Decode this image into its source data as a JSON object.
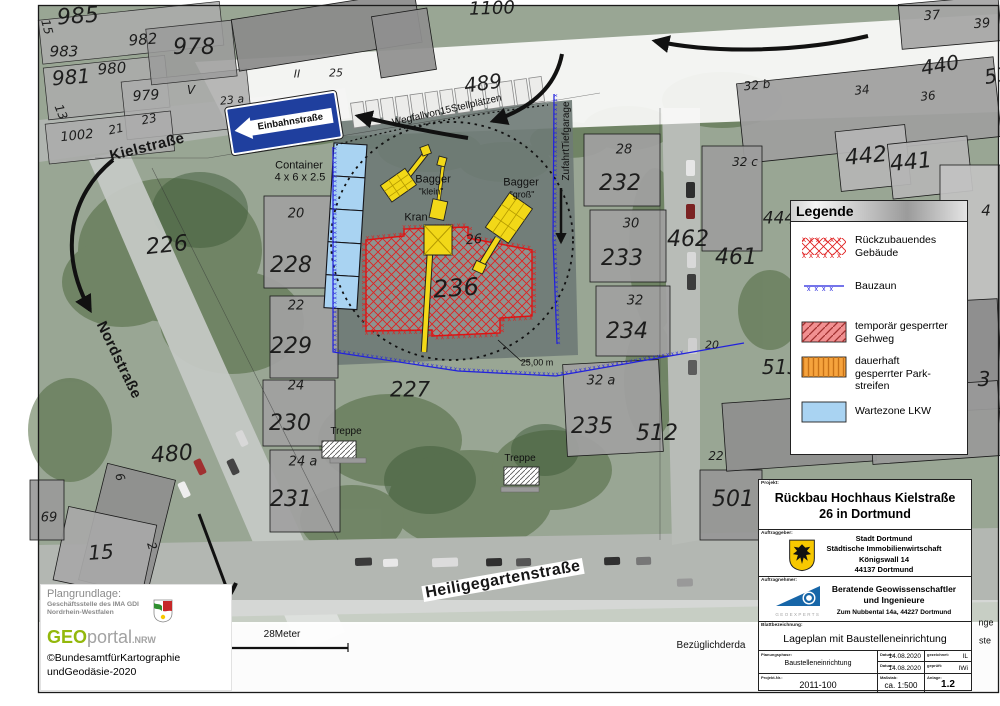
{
  "map": {
    "sign_label": "Einbahnstraße",
    "streets": [
      {
        "t": "Kielstraße",
        "x": 147,
        "y": 147,
        "fs": 15,
        "rot": -14
      },
      {
        "t": "Nordstraße",
        "x": 119,
        "y": 360,
        "fs": 15,
        "rot": 64
      },
      {
        "t": "Heiligegartenstraße",
        "x": 503,
        "y": 580,
        "fs": 16,
        "rot": -10,
        "bg": 1
      }
    ],
    "parcels": [
      {
        "t": "985",
        "x": 78,
        "y": 17,
        "fs": 22,
        "rot": -4
      },
      {
        "t": "15",
        "x": 47,
        "y": 27,
        "fs": 12,
        "rot": 75
      },
      {
        "t": "983",
        "x": 64,
        "y": 52,
        "fs": 15,
        "rot": 0
      },
      {
        "t": "982",
        "x": 143,
        "y": 40,
        "fs": 15,
        "rot": -4
      },
      {
        "t": "978",
        "x": 194,
        "y": 48,
        "fs": 22,
        "rot": 0
      },
      {
        "t": "981",
        "x": 71,
        "y": 77,
        "fs": 20,
        "rot": -4
      },
      {
        "t": "980",
        "x": 112,
        "y": 69,
        "fs": 15,
        "rot": -4
      },
      {
        "t": "979",
        "x": 146,
        "y": 96,
        "fs": 14,
        "rot": -4
      },
      {
        "t": "V",
        "x": 191,
        "y": 90,
        "fs": 12,
        "rot": 0
      },
      {
        "t": "23 a",
        "x": 232,
        "y": 100,
        "fs": 11,
        "rot": -6
      },
      {
        "t": "13",
        "x": 61,
        "y": 112,
        "fs": 12,
        "rot": 68
      },
      {
        "t": "21",
        "x": 116,
        "y": 129,
        "fs": 12,
        "rot": -12
      },
      {
        "t": "23",
        "x": 149,
        "y": 119,
        "fs": 12,
        "rot": -12
      },
      {
        "t": "1002",
        "x": 77,
        "y": 136,
        "fs": 13,
        "rot": -6
      },
      {
        "t": "II",
        "x": 297,
        "y": 74,
        "fs": 11,
        "rot": 0
      },
      {
        "t": "25",
        "x": 336,
        "y": 73,
        "fs": 11,
        "rot": 0
      },
      {
        "t": "1100",
        "x": 492,
        "y": 9,
        "fs": 18,
        "rot": -2
      },
      {
        "t": "489",
        "x": 483,
        "y": 83,
        "fs": 20,
        "rot": -8
      },
      {
        "t": "37",
        "x": 932,
        "y": 16,
        "fs": 13,
        "rot": -4
      },
      {
        "t": "39",
        "x": 982,
        "y": 24,
        "fs": 13,
        "rot": -4
      },
      {
        "t": "440",
        "x": 940,
        "y": 65,
        "fs": 20,
        "rot": -10
      },
      {
        "t": "51",
        "x": 997,
        "y": 75,
        "fs": 20,
        "rot": -10
      },
      {
        "t": "32 b",
        "x": 757,
        "y": 85,
        "fs": 12,
        "rot": -6
      },
      {
        "t": "34",
        "x": 862,
        "y": 90,
        "fs": 12,
        "rot": -6
      },
      {
        "t": "36",
        "x": 928,
        "y": 96,
        "fs": 12,
        "rot": -6
      },
      {
        "t": "32 c",
        "x": 745,
        "y": 162,
        "fs": 12,
        "rot": 0
      },
      {
        "t": "442",
        "x": 866,
        "y": 157,
        "fs": 22,
        "rot": -6
      },
      {
        "t": "441",
        "x": 911,
        "y": 163,
        "fs": 22,
        "rot": -6
      },
      {
        "t": "444",
        "x": 779,
        "y": 219,
        "fs": 17,
        "rot": 0
      },
      {
        "t": "4",
        "x": 986,
        "y": 211,
        "fs": 15,
        "rot": 0
      },
      {
        "t": "462",
        "x": 688,
        "y": 240,
        "fs": 22,
        "rot": 0
      },
      {
        "t": "461",
        "x": 736,
        "y": 258,
        "fs": 22,
        "rot": 0
      },
      {
        "t": "226",
        "x": 167,
        "y": 246,
        "fs": 22,
        "rot": -6
      },
      {
        "t": "20",
        "x": 296,
        "y": 214,
        "fs": 13,
        "rot": 0
      },
      {
        "t": "228",
        "x": 291,
        "y": 266,
        "fs": 22,
        "rot": 0
      },
      {
        "t": "22",
        "x": 296,
        "y": 306,
        "fs": 13,
        "rot": 0
      },
      {
        "t": "229",
        "x": 291,
        "y": 347,
        "fs": 22,
        "rot": 0
      },
      {
        "t": "24",
        "x": 296,
        "y": 386,
        "fs": 13,
        "rot": 0
      },
      {
        "t": "230",
        "x": 290,
        "y": 424,
        "fs": 22,
        "rot": 0
      },
      {
        "t": "24 a",
        "x": 303,
        "y": 462,
        "fs": 13,
        "rot": 0
      },
      {
        "t": "231",
        "x": 291,
        "y": 500,
        "fs": 22,
        "rot": 0
      },
      {
        "t": "28",
        "x": 624,
        "y": 150,
        "fs": 13,
        "rot": 0
      },
      {
        "t": "232",
        "x": 620,
        "y": 184,
        "fs": 22,
        "rot": 0
      },
      {
        "t": "30",
        "x": 631,
        "y": 224,
        "fs": 13,
        "rot": 0
      },
      {
        "t": "233",
        "x": 622,
        "y": 259,
        "fs": 22,
        "rot": 0
      },
      {
        "t": "32",
        "x": 635,
        "y": 301,
        "fs": 13,
        "rot": 0
      },
      {
        "t": "234",
        "x": 627,
        "y": 332,
        "fs": 22,
        "rot": 0
      },
      {
        "t": "32 a",
        "x": 601,
        "y": 381,
        "fs": 13,
        "rot": 0
      },
      {
        "t": "235",
        "x": 592,
        "y": 427,
        "fs": 22,
        "rot": 0
      },
      {
        "t": "512",
        "x": 657,
        "y": 434,
        "fs": 22,
        "rot": 0
      },
      {
        "t": "22",
        "x": 716,
        "y": 456,
        "fs": 12,
        "rot": 0
      },
      {
        "t": "501",
        "x": 733,
        "y": 500,
        "fs": 22,
        "rot": 0
      },
      {
        "t": "513",
        "x": 781,
        "y": 367,
        "fs": 20,
        "rot": 0
      },
      {
        "t": "3",
        "x": 984,
        "y": 379,
        "fs": 20,
        "rot": 0
      },
      {
        "t": "20",
        "x": 712,
        "y": 345,
        "fs": 11,
        "rot": 0
      },
      {
        "t": "480",
        "x": 172,
        "y": 455,
        "fs": 22,
        "rot": -5
      },
      {
        "t": "69",
        "x": 49,
        "y": 518,
        "fs": 13,
        "rot": 0
      },
      {
        "t": "15",
        "x": 101,
        "y": 552,
        "fs": 20,
        "rot": -4
      },
      {
        "t": "6",
        "x": 120,
        "y": 477,
        "fs": 12,
        "rot": 72
      },
      {
        "t": "2",
        "x": 152,
        "y": 546,
        "fs": 12,
        "rot": 72
      },
      {
        "t": "26",
        "x": 474,
        "y": 240,
        "fs": 13,
        "rot": -5
      },
      {
        "t": "236",
        "x": 456,
        "y": 288,
        "fs": 24,
        "rot": -4
      },
      {
        "t": "227",
        "x": 410,
        "y": 390,
        "fs": 21,
        "rot": 0
      }
    ],
    "annotations": [
      {
        "t": "Container",
        "x": 299,
        "y": 166,
        "fs": 11
      },
      {
        "t": "4 x 6 x 2.5",
        "x": 300,
        "y": 178,
        "fs": 11
      },
      {
        "t": "Wegfallvon15Stellplätzen",
        "x": 447,
        "y": 111,
        "fs": 10,
        "rot": -13
      },
      {
        "t": "ZufahrtTiefgarage",
        "x": 567,
        "y": 141,
        "fs": 10,
        "rot": -90
      },
      {
        "t": "Bagger",
        "x": 433,
        "y": 180,
        "fs": 11
      },
      {
        "t": "\"klein\"",
        "x": 431,
        "y": 192,
        "fs": 9
      },
      {
        "t": "Bagger",
        "x": 521,
        "y": 183,
        "fs": 11
      },
      {
        "t": "\"groß\"",
        "x": 522,
        "y": 195,
        "fs": 9
      },
      {
        "t": "Kran",
        "x": 416,
        "y": 218,
        "fs": 11
      },
      {
        "t": "25,00 m",
        "x": 537,
        "y": 363,
        "fs": 9
      },
      {
        "t": "Treppe",
        "x": 346,
        "y": 432,
        "fs": 10
      },
      {
        "t": "Treppe",
        "x": 520,
        "y": 459,
        "fs": 10
      },
      {
        "t": "28Meter",
        "x": 282,
        "y": 635,
        "fs": 10
      },
      {
        "t": "Bezüglichderda",
        "x": 711,
        "y": 646,
        "fs": 10
      },
      {
        "t": "nge",
        "x": 986,
        "y": 623,
        "fs": 9
      },
      {
        "t": "ste",
        "x": 985,
        "y": 641,
        "fs": 9
      }
    ]
  },
  "legend": {
    "title": "Legende",
    "items": [
      {
        "label": "Rückzubauendes Gebäude",
        "swatch": "red-x-hatch"
      },
      {
        "label": "Bauzaun",
        "swatch": "blue-fence-line"
      },
      {
        "label": "temporär gesperrter Gehweg",
        "swatch": "red-diagonal-hatch"
      },
      {
        "label": "dauerhaft gesperrter Park-streifen",
        "swatch": "orange-vertical-hatch"
      },
      {
        "label": "Wartezone LKW",
        "swatch": "light-blue-fill"
      }
    ]
  },
  "titleblock": {
    "projekt_label": "Projekt:",
    "projekt": "Rückbau Hochhaus Kielstraße 26 in Dortmund",
    "auftraggeber_label": "Auftraggeber:",
    "client": [
      "Stadt Dortmund",
      "Städtische Immobilienwirtschaft",
      "Königswall 14",
      "44137 Dortmund"
    ],
    "auftragnehmer_label": "Auftragnehmer:",
    "contractor_line1": "Beratende Geowissenschaftler",
    "contractor_line2": "und Ingenieure",
    "contractor_addr": "Zum Nubbental 14a,  44227 Dortmund",
    "geoexperts_caption": "GEOEXPERTS",
    "blatt_label": "Blattbezeichnung:",
    "blatt": "Lageplan mit Baustelleneinrichtung",
    "phase_label": "Planungsphase:",
    "phase": "Baustelleneinrichtung",
    "datum_label": "Datum:",
    "datum1": "14.08.2020",
    "datum2": "14.08.2020",
    "gezeichnet_label": "gezeichnet:",
    "gezeichnet": "IL",
    "geprueft_label": "geprüft:",
    "geprueft": "IWi",
    "projektnr_label": "Projekt-Nr.:",
    "projektnr": "2011-100",
    "massstab_label": "Maßstab:",
    "massstab": "ca. 1:500",
    "anlage_label": "Anlage:",
    "anlage": "1.2"
  },
  "footer": {
    "plangrundlage_label": "Plangrundlage:",
    "org_line1": "Geschäftsstelle des IMA GDI",
    "org_line2": "Nordrhein-Westfalen",
    "logo_geo": "GEO",
    "logo_portal": "portal",
    "logo_nrw": ".NRW",
    "copyright_line1": "©BundesamtfürKartographie",
    "copyright_line2": "undGeodäsie-2020"
  },
  "colors": {
    "demolition_red": "#e02020",
    "fence_blue": "#2222dd",
    "walkway_pink": "#f19091",
    "parking_orange": "#f6a33d",
    "truck_zone_blue": "#a9d3f2",
    "sign_blue": "#1f3f9e",
    "geo_green": "#93b80c"
  }
}
